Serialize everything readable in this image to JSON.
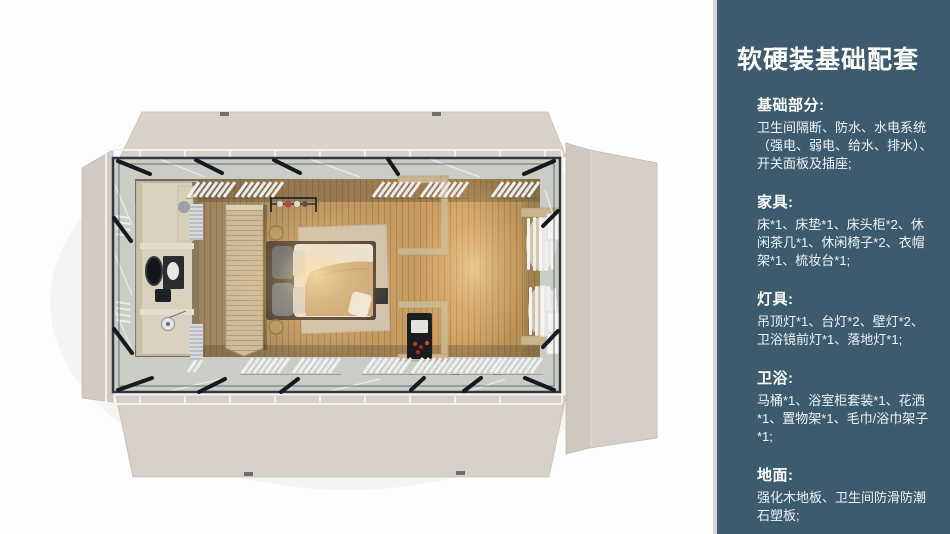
{
  "page": {
    "background": "#ffffff",
    "divider_color": "#d6d6d6"
  },
  "sidebar": {
    "background": "#3e5b6e",
    "text_color": "#ffffff",
    "title": "软硬装基础配套",
    "sections": [
      {
        "heading": "基础部分:",
        "body": "卫生间隔断、防水、水电系统（强电、弱电、给水、排水）、开关面板及插座;"
      },
      {
        "heading": "家具:",
        "body": "床*1、床垫*1、床头柜*2、休闲茶几*1、休闲椅子*2、衣帽架*1、梳妆台*1;"
      },
      {
        "heading": "灯具:",
        "body": "吊顶灯*1、台灯*2、壁灯*2、卫浴镜前灯*1、落地灯*1;"
      },
      {
        "heading": "卫浴:",
        "body": "马桶*1、浴室柜套装*1、花洒*1、置物架*1、毛巾/浴巾架子*1;"
      },
      {
        "heading": "地面:",
        "body": "强化木地板、卫生间防滑防潮石塑板;"
      }
    ]
  },
  "floorplan": {
    "description": "Top-down 3D render of a prefab container suite: fold-out beige wall panels around a steel frame, bathroom with vanity and shower at left, wood wardrobe partition, double bed on rug with warm lamp glow, shelving with black mini cabinet, white louvre panels along walls, white curtains at right end",
    "colors": {
      "panel_beige": "#d6cfc7",
      "panel_edge": "#c3bbb2",
      "steel_frame": "#33383f",
      "walkway_glass": "#c9cdc5",
      "wood_floor": "#bb9560",
      "bathroom_wall": "#d9d1c0",
      "wardrobe_wood": "#cdbb9a",
      "bed_duvet": "#eae6de",
      "bed_blanket": "#c8a273",
      "pillow_gray": "#5f6771",
      "lamp_glow": "#ffe3ad",
      "louvre_white": "#eef0f3"
    }
  }
}
